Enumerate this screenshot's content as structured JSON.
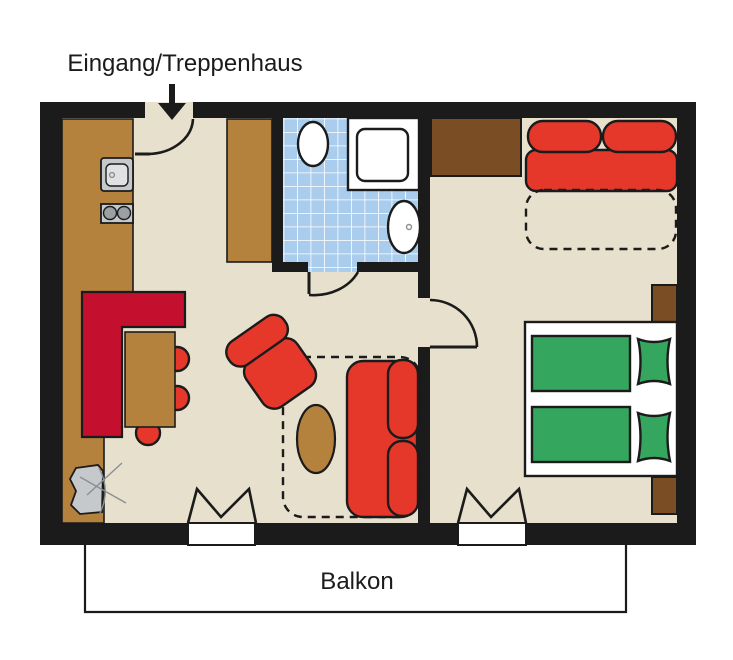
{
  "labels": {
    "entrance": "Eingang/Treppenhaus",
    "balcony": "Balkon"
  },
  "palette": {
    "wall": "#1b1b1b",
    "line": "#1b1b1b",
    "floor": "#e7e0cd",
    "counter": "#b5823e",
    "wooddark": "#7b4d24",
    "red": "#e5382b",
    "crimson": "#c50f2f",
    "green": "#35a65e",
    "tile": "#aacdee",
    "tileline": "#ffffff",
    "fixture": "#c6c9cb",
    "fixturelight": "#dfe1e2",
    "knob": "#9aa0a4",
    "white": "#ffffff"
  }
}
